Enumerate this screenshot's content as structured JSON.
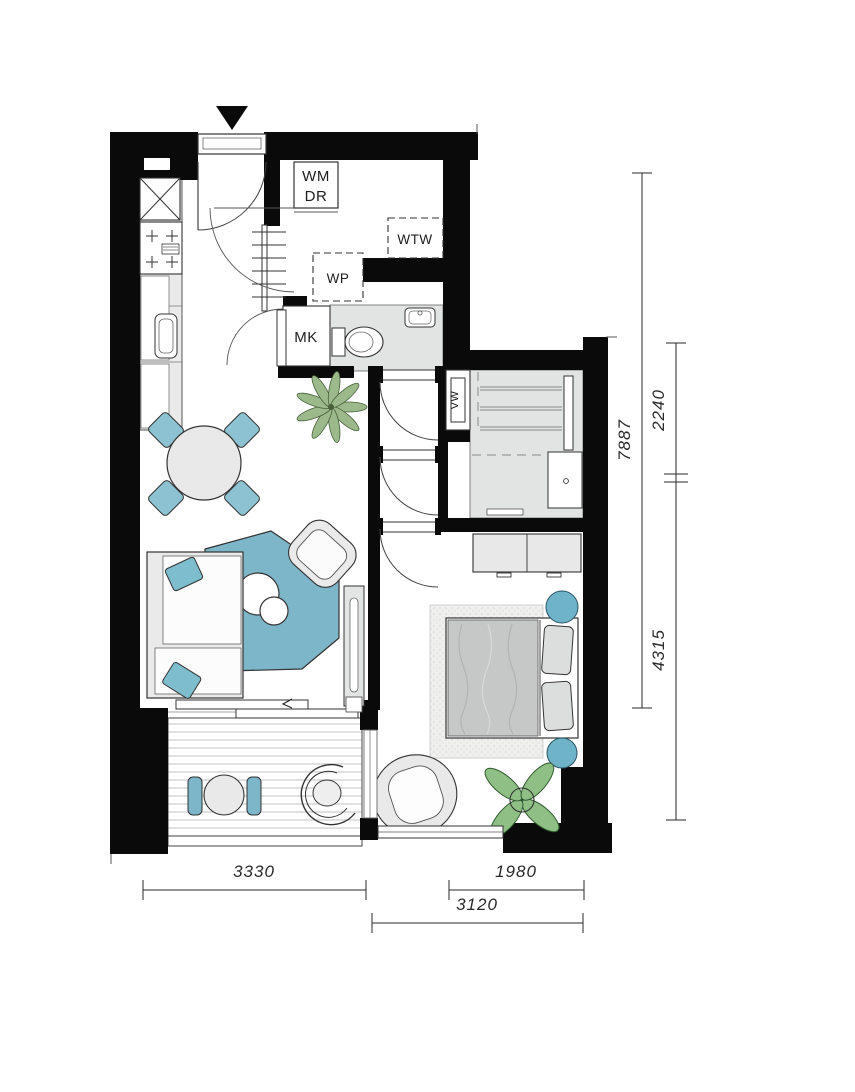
{
  "title": "apartment-floor-plan",
  "labels": {
    "washer": "WM",
    "dryer": "DR",
    "heat_recovery": "WTW",
    "heat_pump": "WP",
    "meter_cupboard": "MK",
    "heater": "VW"
  },
  "dimensions": {
    "right_total": "7887",
    "right_upper": "2240",
    "right_lower": "4315",
    "bottom_left": "3330",
    "bottom_right": "1980",
    "bottom_overall": "3120"
  },
  "colors": {
    "wall": "#0a0a0a",
    "floor_gray": "#e3e5e4",
    "rug_blue": "#7db6c8",
    "chair_blue": "#8cc2d1",
    "stool_blue": "#6fb3c8",
    "pillow_blue": "#7ebdcd",
    "plant_green": "#9cb98b",
    "plant_green_dark": "#8fbf85",
    "furniture_light": "#e9eae9",
    "outline": "#333333"
  }
}
